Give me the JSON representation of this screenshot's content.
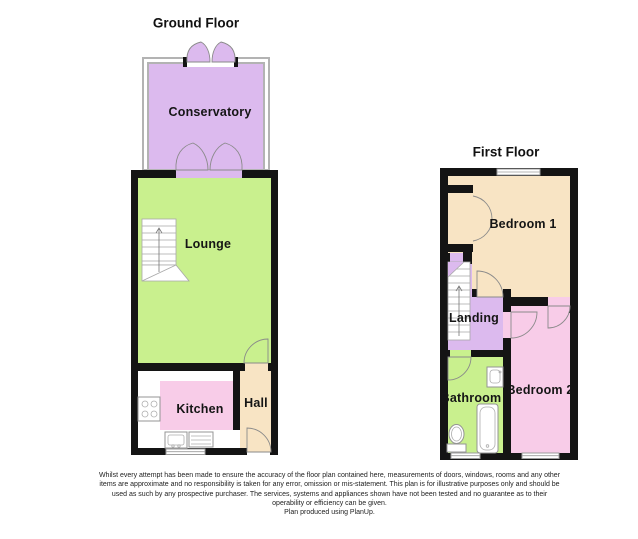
{
  "ground_floor": {
    "title": "Ground Floor",
    "rooms": [
      {
        "label": "Conservatory",
        "color_key": "purple"
      },
      {
        "label": "Lounge",
        "color_key": "green"
      },
      {
        "label": "Kitchen",
        "color_key": "pink"
      },
      {
        "label": "Hall",
        "color_key": "tan"
      }
    ]
  },
  "first_floor": {
    "title": "First Floor",
    "rooms": [
      {
        "label": "Bedroom 1",
        "color_key": "tan"
      },
      {
        "label": "Landing",
        "color_key": "purple"
      },
      {
        "label": "Bathroom",
        "color_key": "green"
      },
      {
        "label": "Bedroom 2",
        "color_key": "pink"
      }
    ]
  },
  "footer": {
    "disclaimer_lines": [
      "Whilst every attempt has been made to ensure the accuracy of the floor plan contained here, measurements of doors, windows, rooms and any other",
      "items are approximate and no responsibility is taken for any error, omission or mis-statement.  This plan is for illustrative purposes only and should be",
      "used as such by any prospective purchaser.  The services, systems and appliances shown have not been tested and no guarantee as to their",
      "operability or efficiency can be given.",
      "Plan produced using PlanUp."
    ]
  },
  "colors": {
    "wall": "#141414",
    "purple": "#dcbaee",
    "green": "#c9f08e",
    "pink": "#f8cce8",
    "tan": "#f8e4c4",
    "line": "#8a8a8a",
    "window": "#9c9c9c"
  }
}
